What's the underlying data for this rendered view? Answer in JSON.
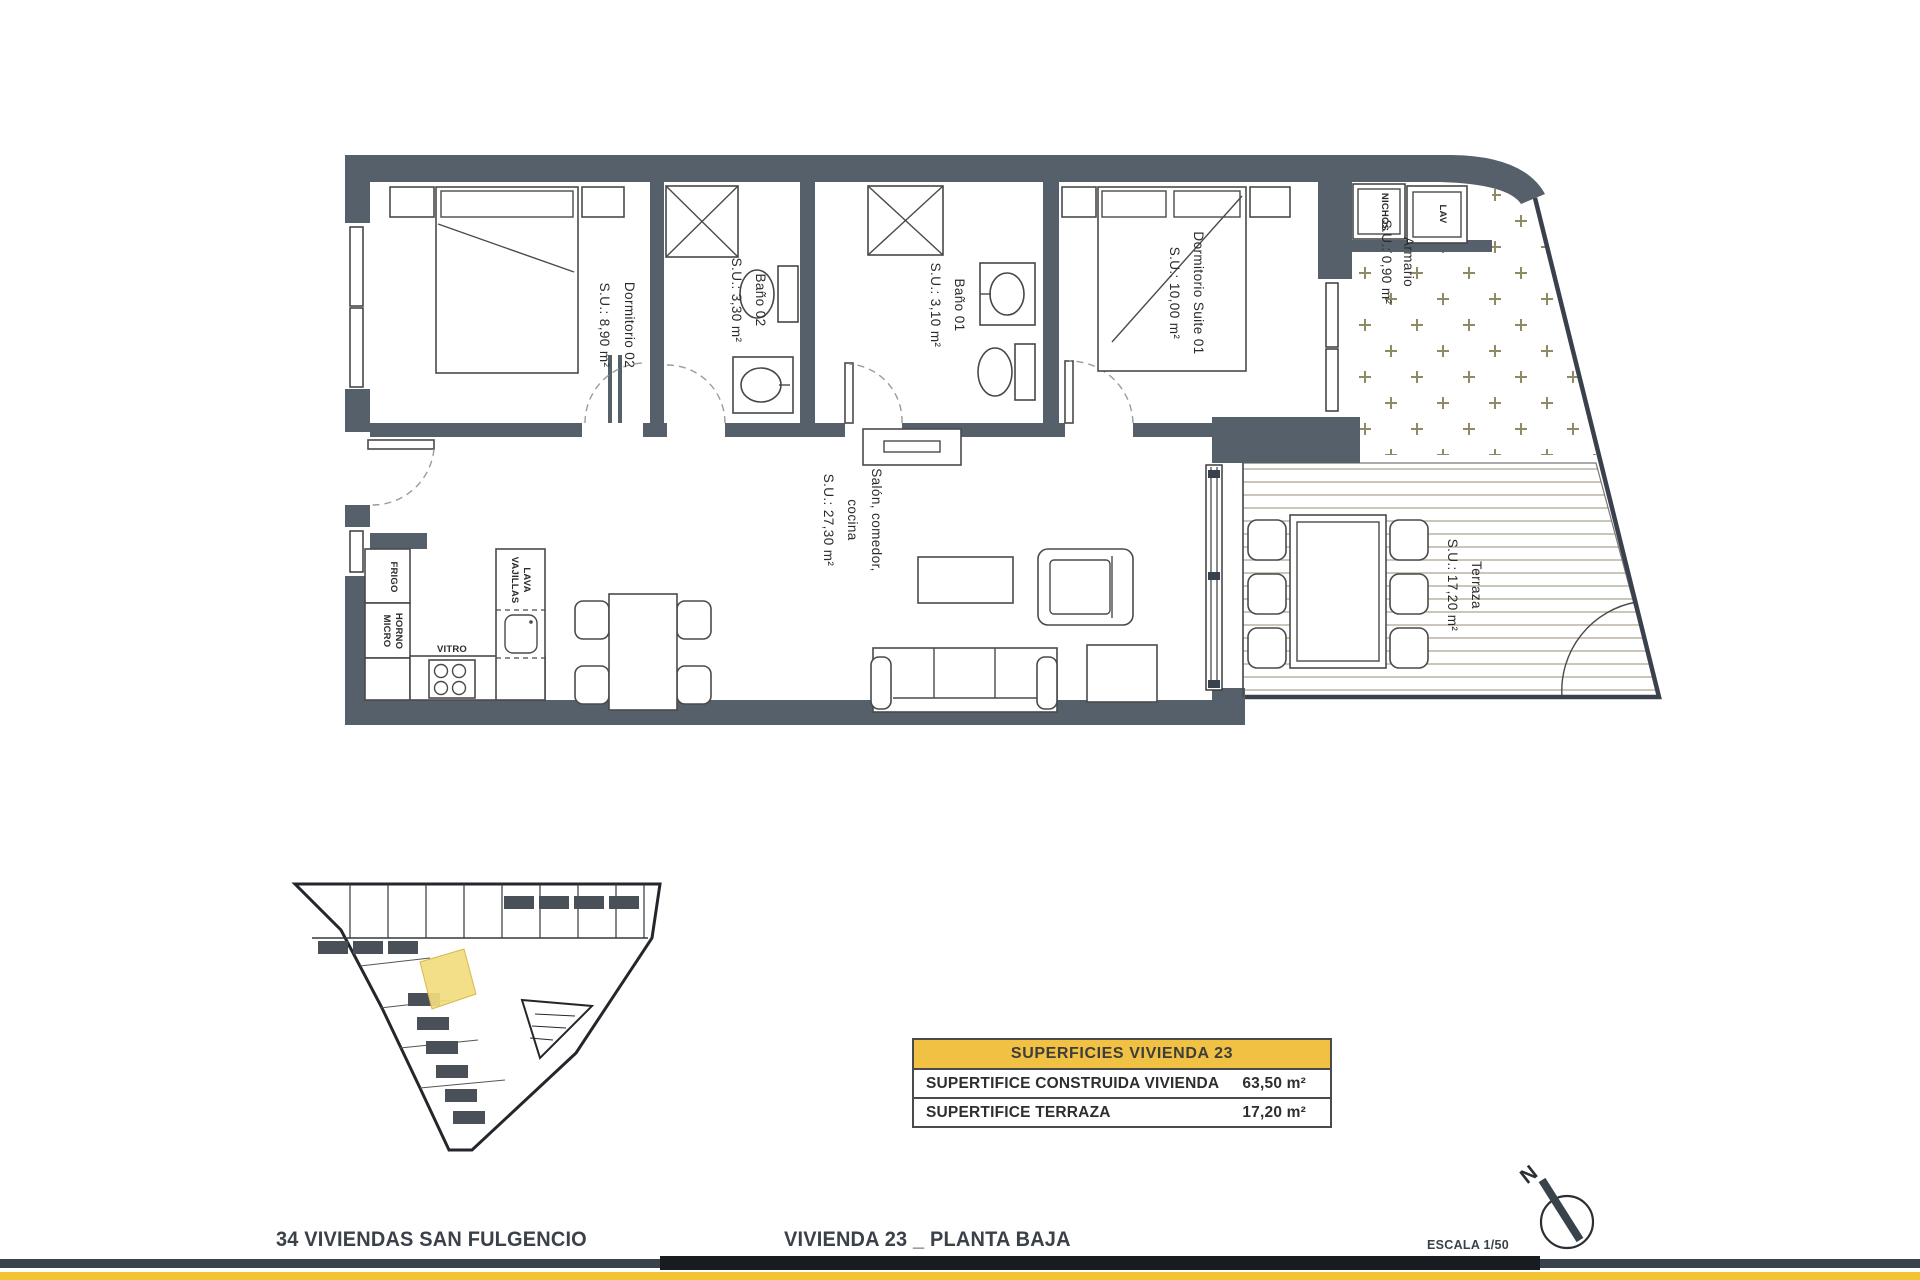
{
  "rooms": {
    "dormitorio02": {
      "name": "Dormitorio 02",
      "area": "S.U.: 8,90 m²"
    },
    "bano02": {
      "name": "Baño 02",
      "area": "S.U.: 3,30 m²"
    },
    "bano01": {
      "name": "Baño 01",
      "area": "S.U.: 3,10 m²"
    },
    "suite01": {
      "name": "Dormitorio Suite 01",
      "area": "S.U.: 10,00 m²"
    },
    "salon": {
      "line1": "Salón, comedor,",
      "line2": "cocina",
      "area": "S.U.: 27,30 m²"
    },
    "terraza": {
      "name": "Terraza",
      "area": "S.U.: 17,20 m²"
    },
    "armario": {
      "name": "Armario",
      "area": "S.U.: 0,90 m²"
    }
  },
  "kitchen": {
    "frigo": "FRIGO",
    "horno1": "HORNO",
    "horno2": "MICRO",
    "vitro": "VITRO",
    "lava1": "LAVA",
    "lava2": "VAJILLAS"
  },
  "laundry": {
    "nichos": "NICHOS",
    "lav": "LAV"
  },
  "summary_table": {
    "header": "SUPERFICIES VIVIENDA 23",
    "rows": [
      {
        "label": "SUPERTIFICE CONSTRUIDA VIVIENDA",
        "value": "63,50 m²"
      },
      {
        "label": "SUPERTIFICE TERRAZA",
        "value": "17,20 m²"
      }
    ]
  },
  "footer": {
    "project": "34 VIVIENDAS SAN FULGENCIO",
    "sheet": "VIVIENDA 23 _ PLANTA BAJA",
    "scale": "ESCALA 1/50",
    "north_letter": "N"
  },
  "colors": {
    "wall": "#56606B",
    "table_header": "#F0C143",
    "accent_bar": "#F3C431",
    "bar_dark": "#171C21",
    "bar_slate": "#3A434B",
    "unit_highlight": "#F2DC7E",
    "plus_pattern": "#8E8A66",
    "deck_line": "#B5AE9C"
  }
}
